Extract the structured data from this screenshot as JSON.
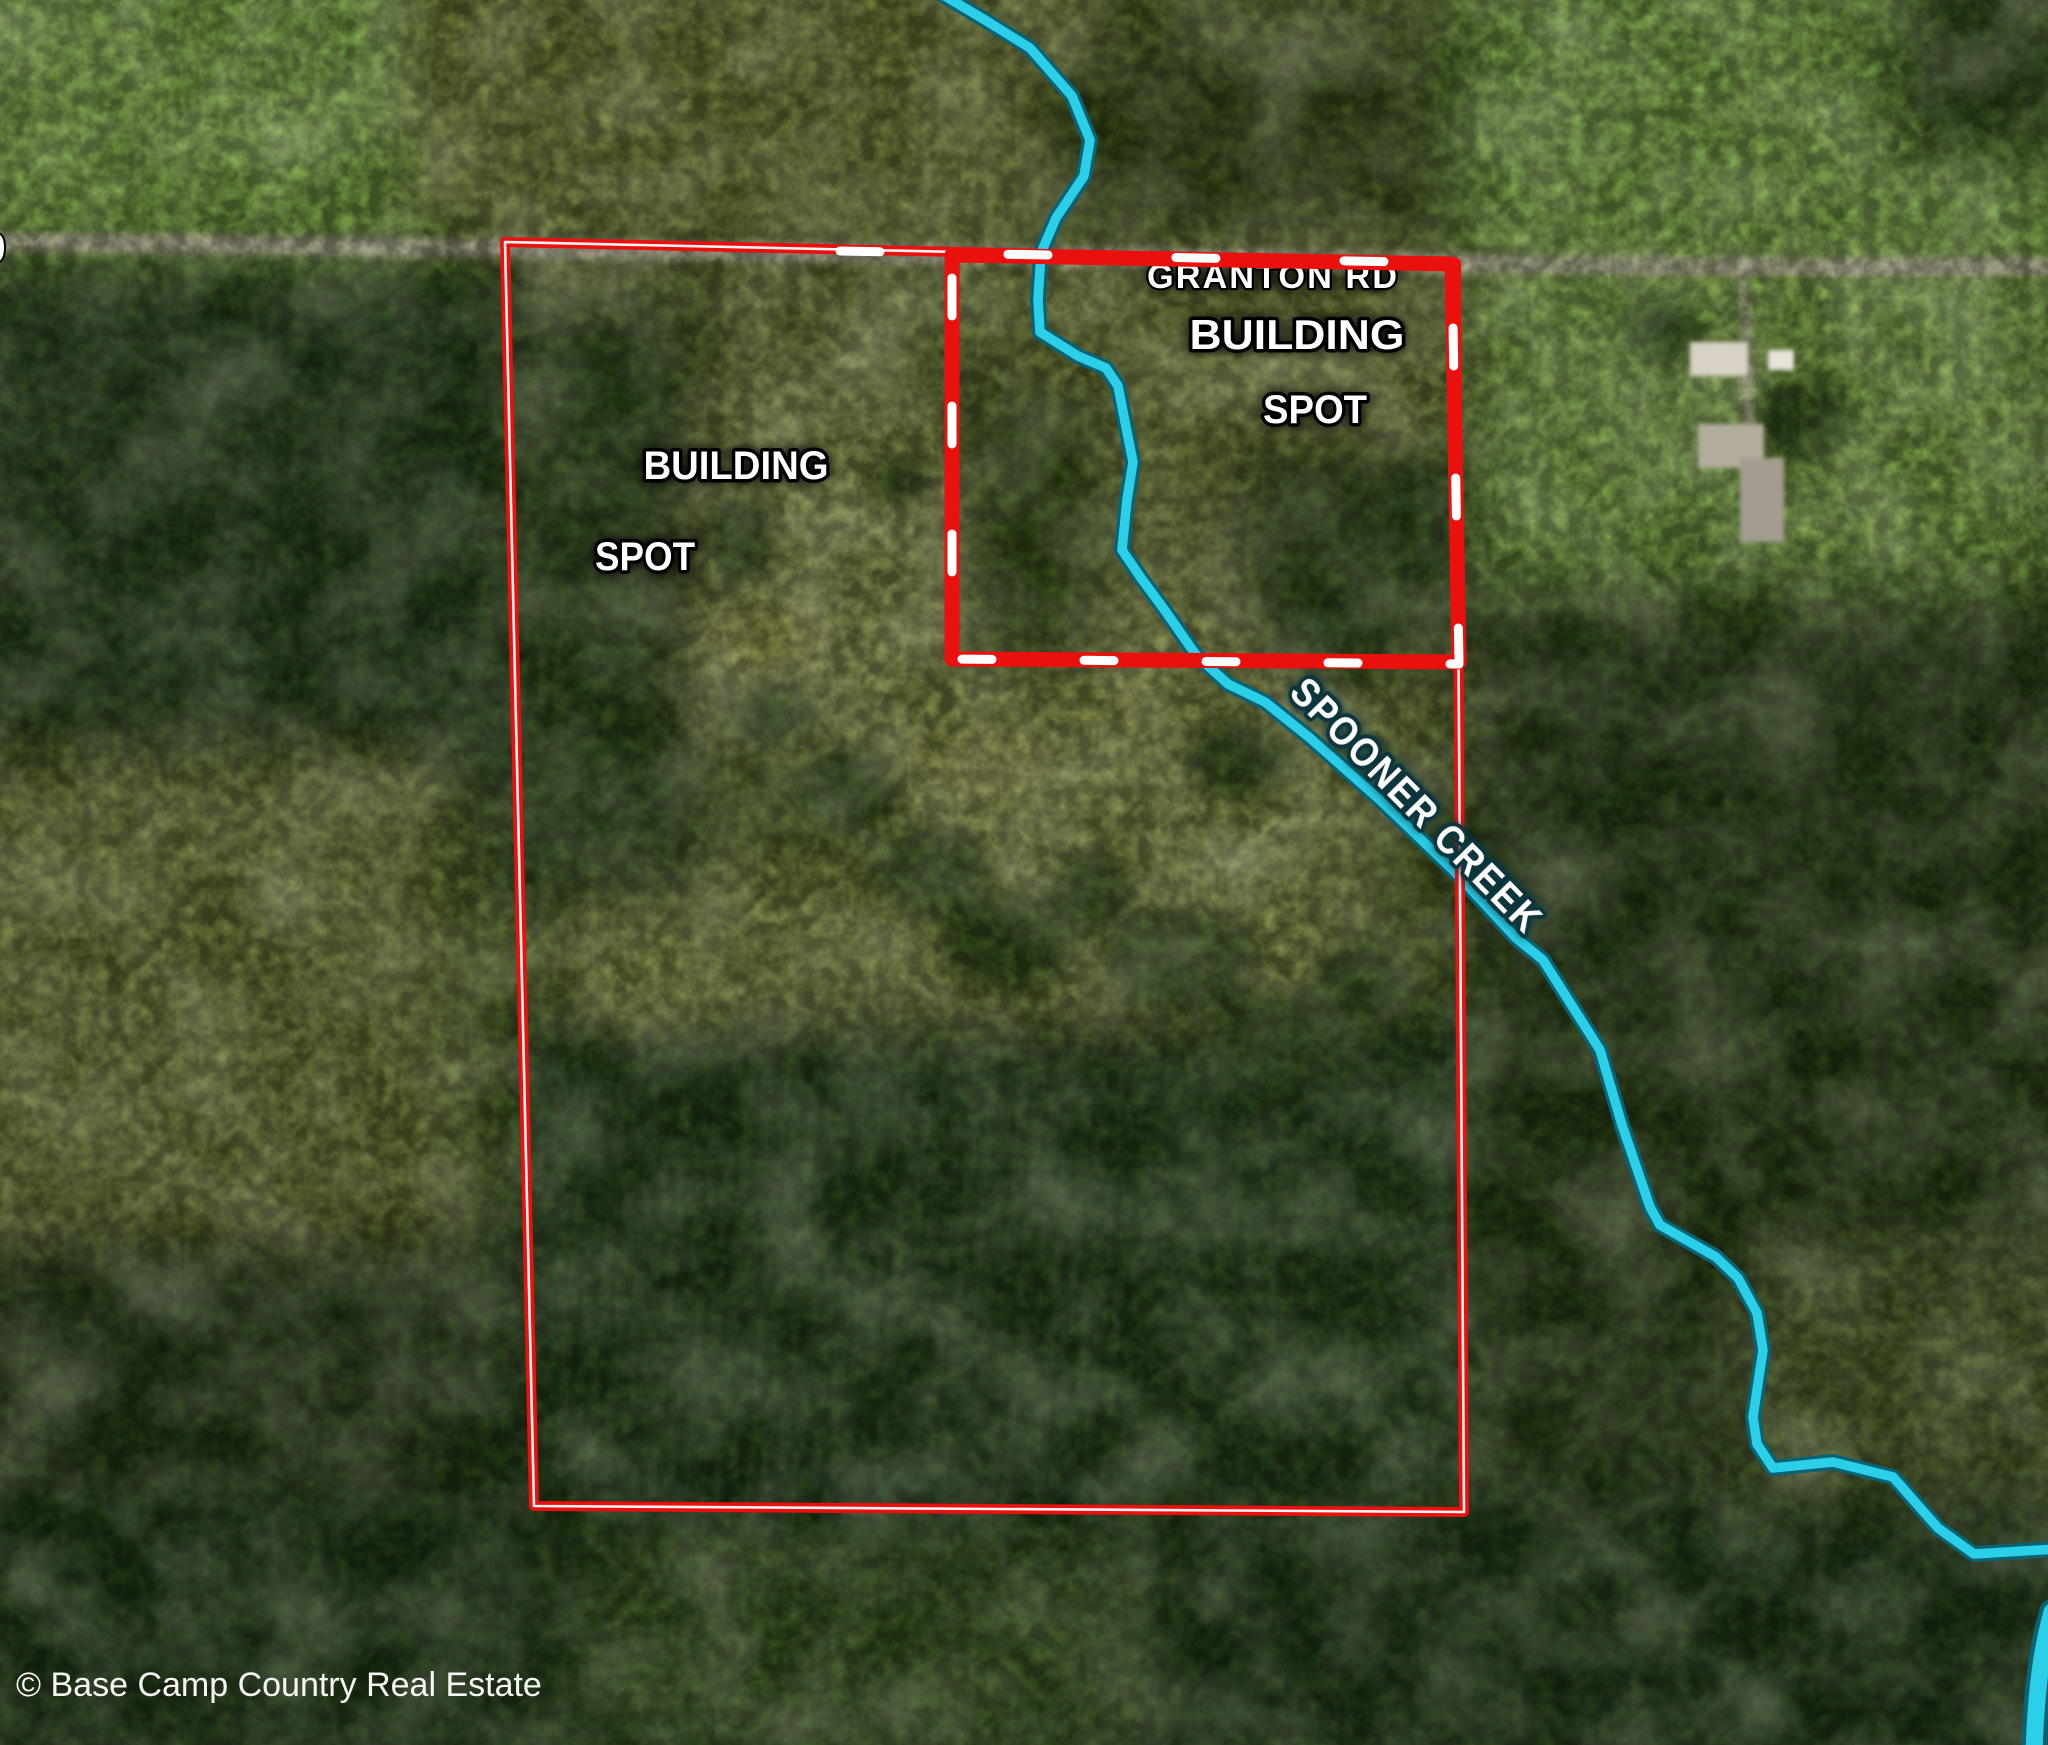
{
  "map": {
    "watermark": "© Base Camp Country Real Estate",
    "road_label": "GRANTON RD",
    "edge_partial_label": "0",
    "creek_label": "SPOONER CREEK",
    "building_spot_left": {
      "line1": "BUILDING",
      "line2": "SPOT"
    },
    "building_spot_right": {
      "line1": "BUILDING",
      "line2": "SPOT"
    },
    "colors": {
      "boundary_red": "#e9100e",
      "dash_white": "#ffffff",
      "creek_fill": "#2ccfe8",
      "creek_edge": "#0a6273",
      "label_text": "#ffffff",
      "road_gray": "#b7b098"
    }
  }
}
